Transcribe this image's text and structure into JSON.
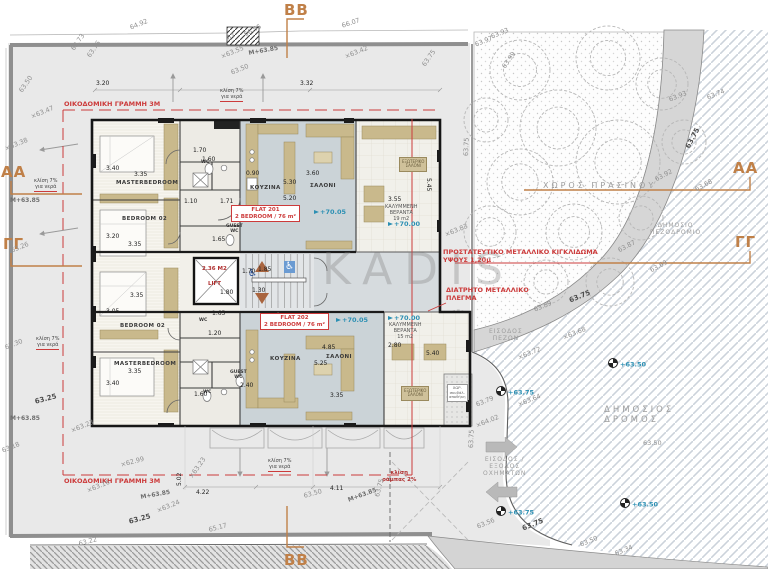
{
  "watermark": "KADIS",
  "colors": {
    "annotation_red": "#cc3b3b",
    "section_orange": "#c08048",
    "level_teal": "#2b8fb3",
    "elevation_gray": "#8f8f8f",
    "living_floor": "#cbd3d7",
    "furniture_tan": "#c9b98c"
  },
  "site": {
    "trees": [
      [
        520,
        70,
        30
      ],
      [
        608,
        58,
        32
      ],
      [
        662,
        84,
        26
      ],
      [
        558,
        128,
        38
      ],
      [
        618,
        162,
        42
      ],
      [
        520,
        182,
        33
      ],
      [
        574,
        232,
        28
      ],
      [
        641,
        218,
        22
      ],
      [
        684,
        142,
        22
      ],
      [
        546,
        282,
        22
      ],
      [
        610,
        282,
        24
      ],
      [
        486,
        120,
        22
      ],
      [
        490,
        232,
        26
      ],
      [
        458,
        322,
        12
      ]
    ],
    "slope_arrows": [
      [
        173,
        102,
        173,
        74
      ],
      [
        263,
        102,
        263,
        74
      ],
      [
        78,
        144,
        40,
        150
      ],
      [
        78,
        228,
        40,
        234
      ],
      [
        240,
        448,
        240,
        476
      ],
      [
        327,
        448,
        327,
        476
      ]
    ]
  },
  "labels": [
    {
      "t": "BB",
      "x": 284,
      "y": 1,
      "c": "section",
      "n": "section-marker-bb-top"
    },
    {
      "t": "BB",
      "x": 284,
      "y": 551,
      "c": "section",
      "n": "section-marker-bb-bottom"
    },
    {
      "t": "AA",
      "x": 1,
      "y": 163,
      "c": "section",
      "n": "section-marker-aa-left"
    },
    {
      "t": "ΓΓ",
      "x": 3,
      "y": 235,
      "c": "section",
      "n": "section-marker-gg-left"
    },
    {
      "t": "AA",
      "x": 733,
      "y": 159,
      "c": "section",
      "n": "section-marker-aa-right"
    },
    {
      "t": "ΓΓ",
      "x": 735,
      "y": 233,
      "c": "section",
      "n": "section-marker-gg-right"
    },
    {
      "t": "ΟΙΚΟΔΟΜΙΚΗ ΓΡΑΜΜΗ 3Μ",
      "x": 64,
      "y": 101,
      "c": "red",
      "n": "building-line-note-top"
    },
    {
      "t": "ΟΙΚΟΔΟΜΙΚΗ ΓΡΑΜΜΗ 3Μ",
      "x": 64,
      "y": 478,
      "c": "red",
      "n": "building-line-note-bottom"
    },
    {
      "t": "ΠΡΟΣΤΑΤΕΥΤΙΚΟ ΜΕΤΑΛΛΙΚΟ ΚΙΓΚΛΙΔΩΜΑ\nΥΨΟΥΣ 1,20μ",
      "x": 443,
      "y": 249,
      "c": "red",
      "n": "railing-note"
    },
    {
      "t": "ΔΙΑΤΡΗΤΟ ΜΕΤΑΛΛΙΚΟ\nΠΛΕΓΜΑ",
      "x": 446,
      "y": 287,
      "c": "red",
      "n": "mesh-note"
    },
    {
      "t": "2.36 Μ2",
      "x": 202,
      "y": 266,
      "c": "redsm",
      "n": "lift-area-label"
    },
    {
      "t": "LIFT",
      "x": 208,
      "y": 281,
      "c": "redsm",
      "n": "lift-label"
    },
    {
      "t": "κλίση\nράμπας 2%",
      "x": 382,
      "y": 470,
      "c": "redsm",
      "n": "ramp-slope-note"
    },
    {
      "t": "FLAT 201\n2 BEDROOM / 76 m²",
      "x": 231,
      "y": 205,
      "c": "flatbox",
      "n": "flat-201-label"
    },
    {
      "t": "FLAT 202\n2 BEDROOM / 76 m²",
      "x": 260,
      "y": 313,
      "c": "flatbox",
      "n": "flat-202-label"
    },
    {
      "t": "+70.05",
      "x": 314,
      "y": 209,
      "c": "lvl",
      "n": "level-marker"
    },
    {
      "t": "+70.00",
      "x": 388,
      "y": 221,
      "c": "lvl",
      "n": "level-marker"
    },
    {
      "t": "+70.05",
      "x": 336,
      "y": 317,
      "c": "lvl",
      "n": "level-marker"
    },
    {
      "t": "+70.00",
      "x": 388,
      "y": 315,
      "c": "lvl",
      "n": "level-marker"
    },
    {
      "t": "+63.50",
      "x": 608,
      "y": 358,
      "c": "survey",
      "n": "survey-marker"
    },
    {
      "t": "+63.50",
      "x": 620,
      "y": 498,
      "c": "survey",
      "n": "survey-marker"
    },
    {
      "t": "+63.75",
      "x": 496,
      "y": 386,
      "c": "survey",
      "n": "survey-marker"
    },
    {
      "t": "+63.75",
      "x": 496,
      "y": 506,
      "c": "survey",
      "n": "survey-marker"
    },
    {
      "t": "ΧΩΡΟΣ ΠΡΑΣΙΝΟΥ",
      "x": 543,
      "y": 181,
      "c": "site",
      "n": "green-space-label"
    },
    {
      "t": "ΔΗΜΟΣΙΟ\nΠΕΖΟΔΡΟΜΙΟ",
      "x": 650,
      "y": 222,
      "c": "sitec",
      "n": "public-sidewalk-label"
    },
    {
      "t": "ΔΗΜΟΣΙΟΣ\nΔΡΟΜΟΣ",
      "x": 604,
      "y": 405,
      "c": "siteb",
      "n": "public-road-label"
    },
    {
      "t": "ΕΙΣΟΔΟΣ\nΠΕΖΩΝ",
      "x": 489,
      "y": 328,
      "c": "sitec",
      "n": "pedestrian-entrance-label"
    },
    {
      "t": "ΕΙΣΟΔΟΣ /\nΕΞΟΔΟΣ\nΟΧΗΜΑΤΩΝ",
      "x": 483,
      "y": 456,
      "c": "sitec",
      "n": "vehicle-entrance-label"
    },
    {
      "t": "κλίση 7%\nγια νερά",
      "x": 220,
      "y": 88,
      "c": "note",
      "n": "slope-note"
    },
    {
      "t": "κλίση 7%\nγια νερά",
      "x": 34,
      "y": 178,
      "c": "note",
      "n": "slope-note"
    },
    {
      "t": "κλίση 7%\nγια νερά",
      "x": 36,
      "y": 336,
      "c": "note",
      "n": "slope-note"
    },
    {
      "t": "κλίση 7%\nγια νερά",
      "x": 268,
      "y": 458,
      "c": "note",
      "n": "slope-note"
    },
    {
      "t": "MASTERBEDROOM",
      "x": 116,
      "y": 180,
      "c": "room",
      "n": "room-label"
    },
    {
      "t": "BEDROOM 02",
      "x": 122,
      "y": 216,
      "c": "room",
      "n": "room-label"
    },
    {
      "t": "ΚΟΥΖΙΝΑ",
      "x": 250,
      "y": 185,
      "c": "room",
      "n": "room-label"
    },
    {
      "t": "ΣΑΛΟΝΙ",
      "x": 310,
      "y": 183,
      "c": "room",
      "n": "room-label"
    },
    {
      "t": "BEDROOM 02",
      "x": 120,
      "y": 323,
      "c": "room",
      "n": "room-label"
    },
    {
      "t": "MASTERBEDROOM",
      "x": 114,
      "y": 361,
      "c": "room",
      "n": "room-label"
    },
    {
      "t": "ΚΟΥΖΙΝΑ",
      "x": 270,
      "y": 356,
      "c": "room",
      "n": "room-label"
    },
    {
      "t": "ΣΑΛΟΝΙ",
      "x": 326,
      "y": 354,
      "c": "room",
      "n": "room-label"
    },
    {
      "t": "WC",
      "x": 201,
      "y": 160,
      "c": "rooms",
      "n": "room-label"
    },
    {
      "t": "GUEST\nWC",
      "x": 226,
      "y": 224,
      "c": "rooms",
      "n": "room-label"
    },
    {
      "t": "WC",
      "x": 199,
      "y": 318,
      "c": "rooms",
      "n": "room-label"
    },
    {
      "t": "GUEST\nWC",
      "x": 230,
      "y": 370,
      "c": "rooms",
      "n": "room-label"
    },
    {
      "t": "WC",
      "x": 203,
      "y": 390,
      "c": "rooms",
      "n": "room-label"
    },
    {
      "t": "ΚΑΛΥΜΜΕΝΗ\nΒΕΡΑΝΤΑ\n19 m2",
      "x": 385,
      "y": 204,
      "c": "cap",
      "n": "veranda-label"
    },
    {
      "t": "ΚΑΛΥΜΜΕΝΗ\nΒΕΡΑΝΤΑ\n15 m2",
      "x": 389,
      "y": 322,
      "c": "cap",
      "n": "veranda-label"
    },
    {
      "t": "ΕΞΩΤΕΡΙΚΟ\nΣΑΛΟΝΙ",
      "x": 399,
      "y": 157,
      "c": "vbox",
      "n": "outdoor-lounge-label"
    },
    {
      "t": "ΕΞΩΤΕΡΙΚΟ\nΣΑΛΟΝΙ",
      "x": 401,
      "y": 386,
      "c": "vbox",
      "n": "outdoor-lounge-label"
    },
    {
      "t": "ΧΩΡ.\nσκυβάλ.\nαποθήκη",
      "x": 447,
      "y": 384,
      "c": "tinybox",
      "n": "garbage-room-label"
    },
    {
      "t": "♿",
      "x": 248,
      "y": 268,
      "c": "wcb",
      "n": "wheelchair-icon"
    },
    {
      "t": "♿",
      "x": 284,
      "y": 261,
      "c": "wcw",
      "n": "wheelchair-icon"
    },
    {
      "t": "3.20",
      "x": 96,
      "y": 80,
      "c": "dim"
    },
    {
      "t": "3.32",
      "x": 300,
      "y": 80,
      "c": "dim"
    },
    {
      "t": "3.40",
      "x": 106,
      "y": 165,
      "c": "dim"
    },
    {
      "t": "3.35",
      "x": 134,
      "y": 171,
      "c": "dim"
    },
    {
      "t": "3.20",
      "x": 106,
      "y": 233,
      "c": "dim"
    },
    {
      "t": "3.35",
      "x": 128,
      "y": 241,
      "c": "dim"
    },
    {
      "t": "1.70",
      "x": 193,
      "y": 147,
      "c": "dim"
    },
    {
      "t": "1.60",
      "x": 202,
      "y": 156,
      "c": "dim"
    },
    {
      "t": "0.90",
      "x": 246,
      "y": 170,
      "c": "dim"
    },
    {
      "t": "3.60",
      "x": 306,
      "y": 170,
      "c": "dim"
    },
    {
      "t": "5.30",
      "x": 283,
      "y": 179,
      "c": "dim"
    },
    {
      "t": "5.20",
      "x": 283,
      "y": 195,
      "c": "dim"
    },
    {
      "t": "1.10",
      "x": 184,
      "y": 198,
      "c": "dim"
    },
    {
      "t": "1.71",
      "x": 220,
      "y": 198,
      "c": "dim"
    },
    {
      "t": "1.65",
      "x": 212,
      "y": 236,
      "c": "dim"
    },
    {
      "t": "1.70",
      "x": 242,
      "y": 268,
      "c": "dim"
    },
    {
      "t": "1.85",
      "x": 258,
      "y": 266,
      "c": "dim"
    },
    {
      "t": "1.30",
      "x": 252,
      "y": 287,
      "c": "dim"
    },
    {
      "t": "1.80",
      "x": 220,
      "y": 289,
      "c": "dim"
    },
    {
      "t": "3.35",
      "x": 130,
      "y": 292,
      "c": "dim"
    },
    {
      "t": "3.05",
      "x": 106,
      "y": 308,
      "c": "dim"
    },
    {
      "t": "1.20",
      "x": 208,
      "y": 330,
      "c": "dim"
    },
    {
      "t": "3.35",
      "x": 128,
      "y": 368,
      "c": "dim"
    },
    {
      "t": "3.40",
      "x": 106,
      "y": 380,
      "c": "dim"
    },
    {
      "t": "2.40",
      "x": 240,
      "y": 382,
      "c": "dim"
    },
    {
      "t": "1.60",
      "x": 194,
      "y": 391,
      "c": "dim"
    },
    {
      "t": "4.85",
      "x": 322,
      "y": 344,
      "c": "dim"
    },
    {
      "t": "5.25",
      "x": 314,
      "y": 360,
      "c": "dim"
    },
    {
      "t": "3.35",
      "x": 330,
      "y": 392,
      "c": "dim"
    },
    {
      "t": "1.65",
      "x": 212,
      "y": 310,
      "c": "dim"
    },
    {
      "t": "3.55",
      "x": 388,
      "y": 196,
      "c": "dim"
    },
    {
      "t": "5.45",
      "x": 432,
      "y": 178,
      "r": 90,
      "c": "dim"
    },
    {
      "t": "2.80",
      "x": 388,
      "y": 342,
      "c": "dim"
    },
    {
      "t": "5.40",
      "x": 426,
      "y": 350,
      "c": "dim"
    },
    {
      "t": "5.02",
      "x": 176,
      "y": 486,
      "r": -90,
      "c": "dim"
    },
    {
      "t": "4.22",
      "x": 196,
      "y": 489,
      "c": "dim"
    },
    {
      "t": "4.11",
      "x": 330,
      "y": 485,
      "c": "dim"
    },
    {
      "t": "64.92",
      "x": 129,
      "y": 25,
      "r": -22,
      "c": "elev"
    },
    {
      "t": "66.07",
      "x": 341,
      "y": 23,
      "r": -18,
      "c": "elev"
    },
    {
      "t": "66.95",
      "x": 243,
      "y": 32,
      "r": -28,
      "c": "elev"
    },
    {
      "t": "67",
      "x": 226,
      "y": 36,
      "r": -28,
      "c": "elev"
    },
    {
      "t": "63.73",
      "x": 70,
      "y": 48,
      "r": -55,
      "c": "elev"
    },
    {
      "t": "63.76",
      "x": 86,
      "y": 55,
      "r": -55,
      "c": "elev"
    },
    {
      "t": "×63.55",
      "x": 220,
      "y": 54,
      "r": -22,
      "c": "elev"
    },
    {
      "t": "M+63.85",
      "x": 248,
      "y": 50,
      "r": -10,
      "c": "bmk"
    },
    {
      "t": "63.50",
      "x": 230,
      "y": 70,
      "r": -22,
      "c": "elev"
    },
    {
      "t": "×63.42",
      "x": 344,
      "y": 54,
      "r": -22,
      "c": "elev"
    },
    {
      "t": "63.50",
      "x": 18,
      "y": 90,
      "r": -55,
      "c": "elev"
    },
    {
      "t": "×63.47",
      "x": 30,
      "y": 114,
      "r": -22,
      "c": "elev"
    },
    {
      "t": "×63.38",
      "x": 4,
      "y": 146,
      "r": -22,
      "c": "elev"
    },
    {
      "t": "M+63.85",
      "x": 10,
      "y": 197,
      "c": "bmk"
    },
    {
      "t": "63.26",
      "x": 10,
      "y": 248,
      "r": -22,
      "c": "elev"
    },
    {
      "t": "63.30",
      "x": 4,
      "y": 345,
      "r": -22,
      "c": "elev"
    },
    {
      "t": "63.25",
      "x": 34,
      "y": 398,
      "r": -15,
      "c": "elevb"
    },
    {
      "t": "63.18",
      "x": 1,
      "y": 448,
      "r": -22,
      "c": "elev"
    },
    {
      "t": "M+63.85",
      "x": 10,
      "y": 415,
      "c": "bmk"
    },
    {
      "t": "×63.23",
      "x": 70,
      "y": 428,
      "r": -22,
      "c": "elev"
    },
    {
      "t": "×62.99",
      "x": 120,
      "y": 462,
      "r": -15,
      "c": "elev"
    },
    {
      "t": "×63.16",
      "x": 86,
      "y": 488,
      "r": -22,
      "c": "elev"
    },
    {
      "t": "M+63.85",
      "x": 140,
      "y": 494,
      "r": -10,
      "c": "bmk"
    },
    {
      "t": "×63.24",
      "x": 156,
      "y": 508,
      "r": -22,
      "c": "elev"
    },
    {
      "t": "63.25",
      "x": 128,
      "y": 518,
      "r": -15,
      "c": "elevb"
    },
    {
      "t": "65.17",
      "x": 208,
      "y": 527,
      "r": -15,
      "c": "elev"
    },
    {
      "t": "63.22",
      "x": 78,
      "y": 541,
      "r": -15,
      "c": "elev"
    },
    {
      "t": "×63.23",
      "x": 188,
      "y": 476,
      "r": -55,
      "c": "elev"
    },
    {
      "t": "63.50",
      "x": 303,
      "y": 493,
      "r": -15,
      "c": "elev"
    },
    {
      "t": "M+63.85",
      "x": 347,
      "y": 497,
      "r": -20,
      "c": "bmk"
    },
    {
      "t": "63.75",
      "x": 374,
      "y": 496,
      "r": -75,
      "c": "elev"
    },
    {
      "t": "63.75",
      "x": 421,
      "y": 64,
      "r": -55,
      "c": "elev"
    },
    {
      "t": "63.97",
      "x": 474,
      "y": 42,
      "r": -22,
      "c": "elev"
    },
    {
      "t": "63.93",
      "x": 490,
      "y": 34,
      "r": -22,
      "c": "elev"
    },
    {
      "t": "63.99",
      "x": 501,
      "y": 66,
      "r": -55,
      "c": "elev"
    },
    {
      "t": "63.93",
      "x": 668,
      "y": 97,
      "r": -22,
      "c": "elev"
    },
    {
      "t": "63.74",
      "x": 706,
      "y": 95,
      "r": -22,
      "c": "elev"
    },
    {
      "t": "63.75",
      "x": 684,
      "y": 146,
      "r": -62,
      "c": "elevb"
    },
    {
      "t": "63.92",
      "x": 654,
      "y": 177,
      "r": -28,
      "c": "elev"
    },
    {
      "t": "63.68",
      "x": 694,
      "y": 187,
      "r": -28,
      "c": "elev"
    },
    {
      "t": "63.87",
      "x": 617,
      "y": 248,
      "r": -28,
      "c": "elev"
    },
    {
      "t": "63.69",
      "x": 649,
      "y": 268,
      "r": -28,
      "c": "elev"
    },
    {
      "t": "×63.83",
      "x": 444,
      "y": 232,
      "r": -22,
      "c": "elev"
    },
    {
      "t": "63.75",
      "x": 463,
      "y": 156,
      "r": -88,
      "c": "elev"
    },
    {
      "t": "63.89",
      "x": 533,
      "y": 307,
      "r": -22,
      "c": "elev"
    },
    {
      "t": "63.75",
      "x": 568,
      "y": 297,
      "r": -22,
      "c": "elevb"
    },
    {
      "t": "×63.68",
      "x": 562,
      "y": 335,
      "r": -22,
      "c": "elev"
    },
    {
      "t": "×63.72",
      "x": 517,
      "y": 355,
      "r": -22,
      "c": "elev"
    },
    {
      "t": "×63.64",
      "x": 517,
      "y": 402,
      "r": -22,
      "c": "elev"
    },
    {
      "t": "63.79",
      "x": 475,
      "y": 402,
      "r": -22,
      "c": "elev"
    },
    {
      "t": "×64.02",
      "x": 475,
      "y": 423,
      "r": -22,
      "c": "elev"
    },
    {
      "t": "63.75",
      "x": 468,
      "y": 448,
      "r": -88,
      "c": "elev"
    },
    {
      "t": "63.50",
      "x": 643,
      "y": 440,
      "c": "elev"
    },
    {
      "t": "63.56",
      "x": 476,
      "y": 524,
      "r": -22,
      "c": "elev"
    },
    {
      "t": "63.75",
      "x": 521,
      "y": 525,
      "r": -22,
      "c": "elevb"
    },
    {
      "t": "63.50",
      "x": 579,
      "y": 542,
      "r": -22,
      "c": "elev"
    },
    {
      "t": "63.34",
      "x": 614,
      "y": 551,
      "r": -22,
      "c": "elev"
    }
  ]
}
